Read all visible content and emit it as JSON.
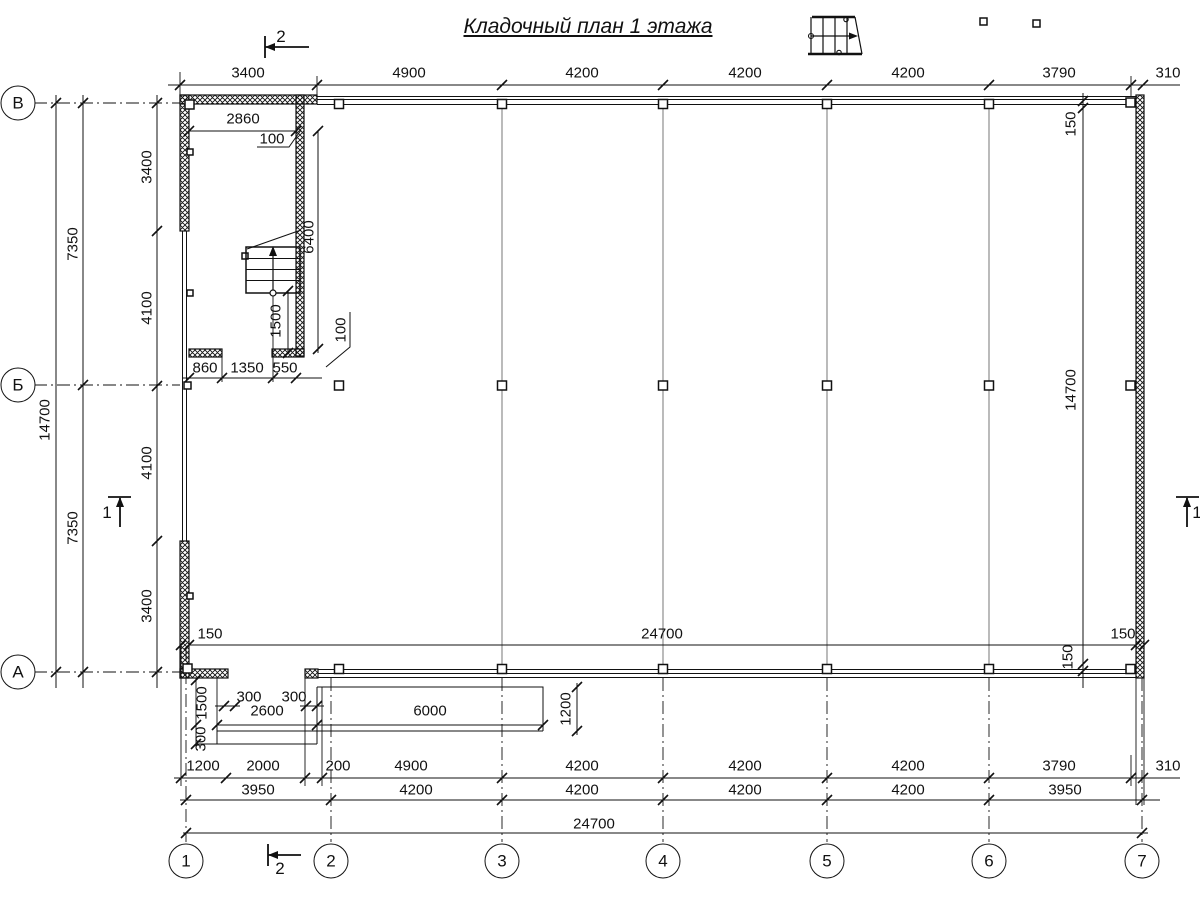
{
  "title": "Кладочный план 1 этажа",
  "axes": {
    "rows": [
      "В",
      "Б",
      "А"
    ],
    "cols": [
      "1",
      "2",
      "3",
      "4",
      "5",
      "6",
      "7"
    ]
  },
  "marks": {
    "sec2_top": "2",
    "sec2_bottom": "2",
    "sec1_left": "1",
    "sec1_right": "1"
  },
  "dims": {
    "top": [
      "3400",
      "4900",
      "4200",
      "4200",
      "4200",
      "3790",
      "310"
    ],
    "left_total": "14700",
    "left_halves": [
      "7350",
      "7350"
    ],
    "left_segs": [
      "3400",
      "4100",
      "4100",
      "3400"
    ],
    "stair": {
      "w": "2860",
      "g1": "100",
      "d": "6400",
      "run": "1500",
      "g2": "100",
      "b": [
        "860",
        "1350",
        "550"
      ]
    },
    "inb": {
      "l": "150",
      "t": "24700",
      "r": "150"
    },
    "inr": {
      "t": "150",
      "m": "14700",
      "b": "150"
    },
    "porch": {
      "s1": "300",
      "s2": "300",
      "stoop": "2600",
      "walk": "6000",
      "ww": "1200",
      "v1": "1500",
      "v2": "300"
    },
    "row1": [
      "1200",
      "2000",
      "200",
      "4900",
      "4200",
      "4200",
      "4200",
      "3790",
      "310"
    ],
    "row2": [
      "3950",
      "4200",
      "4200",
      "4200",
      "4200",
      "3950"
    ],
    "total": "24700"
  }
}
